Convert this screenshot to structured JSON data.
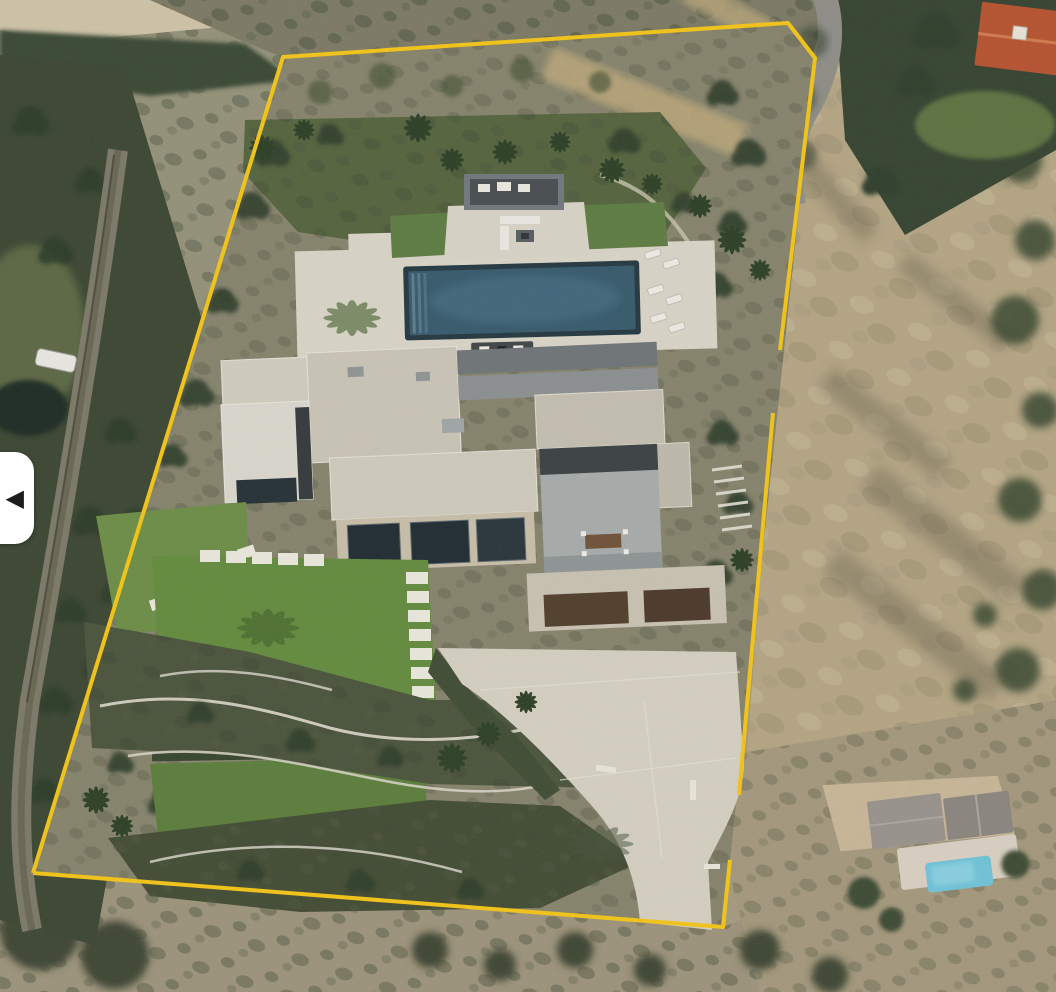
{
  "carousel": {
    "previous_button": {
      "glyph": "◀",
      "label": "previous-photo"
    }
  },
  "scene": {
    "boundary_color": "#F2C315",
    "palette": {
      "pool_water": "#35596B",
      "pool_rim": "#23363F",
      "neighbor_pool": "#6FC2D6",
      "lawn": "#628A3C",
      "lawn_lower": "#5A7C3A",
      "deck": "#D8D3C6",
      "driveway": "#D3CEBF",
      "roof_beige": "#C8C3B5",
      "roof_white": "#D9D6CC",
      "roof_dark": "#6E7376",
      "stone_wall": "#C7BDA7",
      "glass": "#1F2B31",
      "garage_door": "#503D2B",
      "red_roof": "#B5512E",
      "dry_field": "#B3A482",
      "scrub": "#85826B",
      "hillside": "#939078",
      "trees": "#2C3A28",
      "garden": "#49523A",
      "terrace_wall": "#DBD7CA",
      "road": "#8D8D85",
      "button_bg": "#FFFFFF",
      "button_arrow": "#1C1C1C"
    }
  }
}
